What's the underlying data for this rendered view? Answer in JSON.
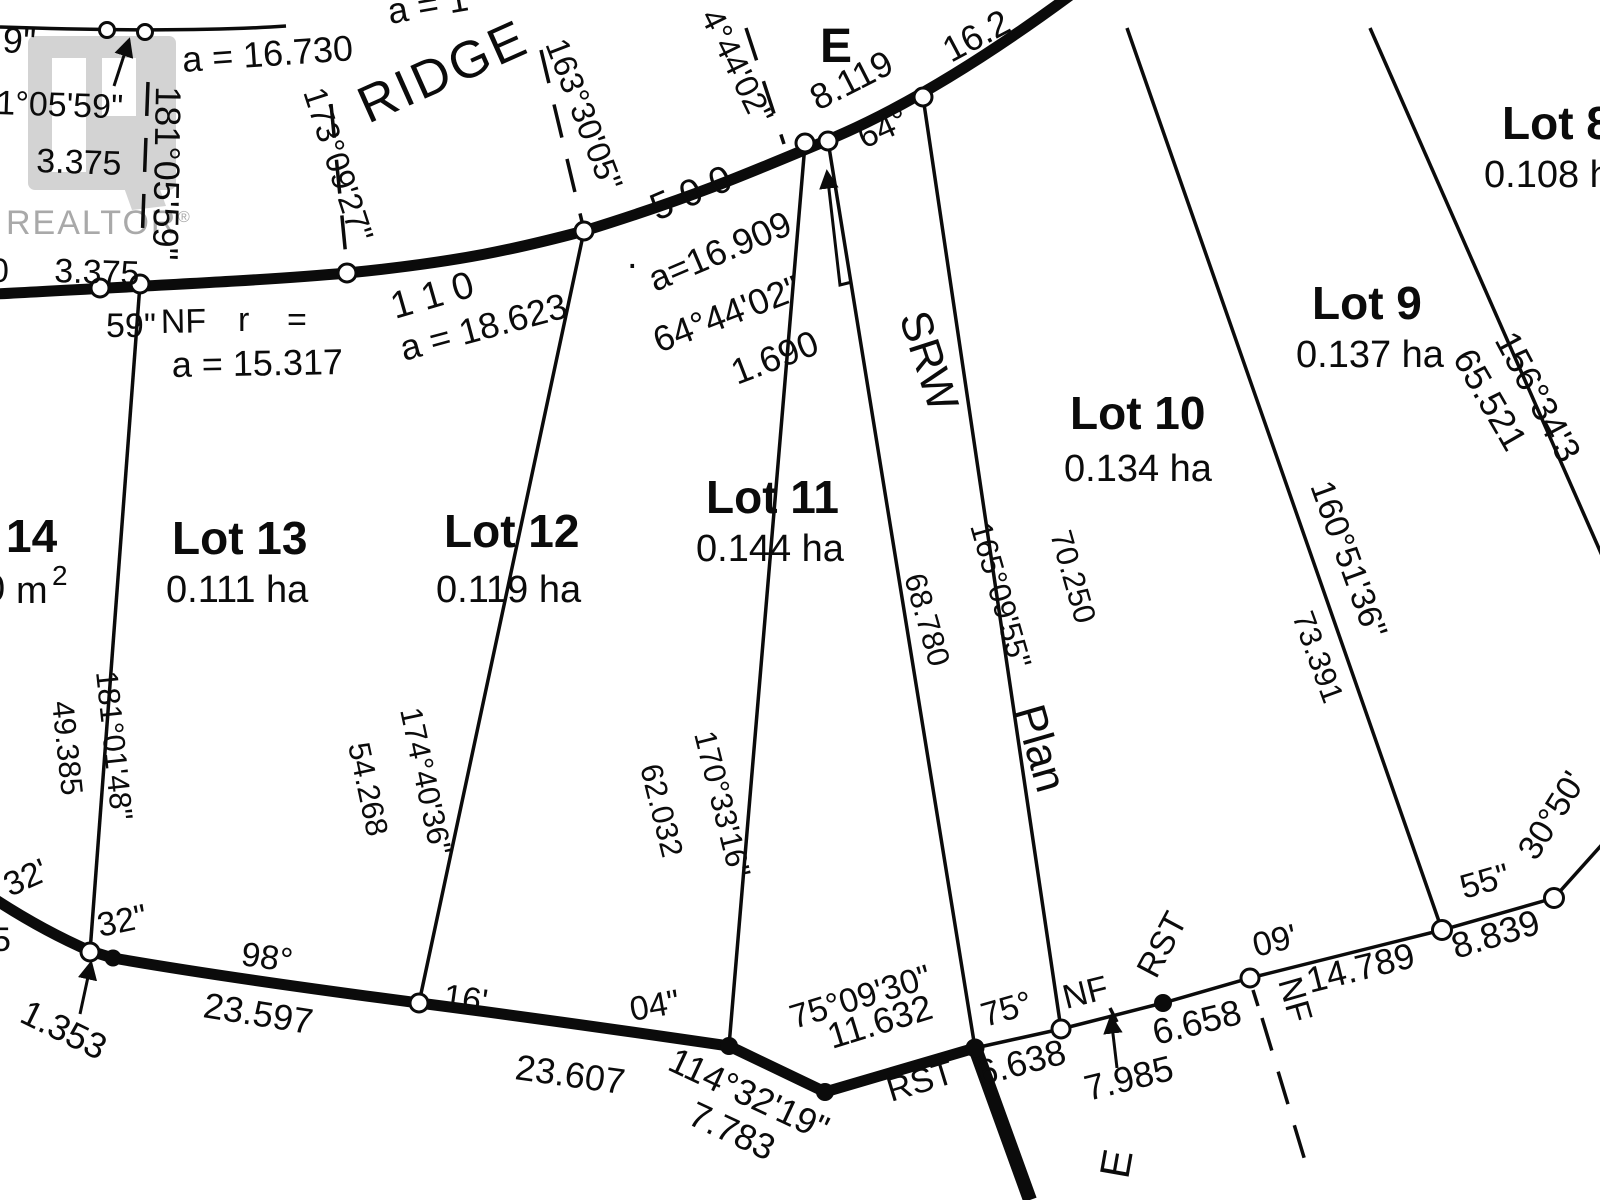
{
  "watermark": {
    "brand": "REALTOR",
    "registered": "®"
  },
  "streets": {
    "ridge": "RIDGE",
    "e_top": "E",
    "e_bottom": "E"
  },
  "srw": {
    "name": "SRW",
    "plan": "Plan"
  },
  "lots": [
    {
      "label": "Lot 8",
      "area": "0.108 ha"
    },
    {
      "label": "Lot 9",
      "area": "0.137 ha"
    },
    {
      "label": "Lot 10",
      "area": "0.134 ha"
    },
    {
      "label": "Lot 11",
      "area": "0.144 ha"
    },
    {
      "label": "Lot 12",
      "area": "0.119 ha"
    },
    {
      "label": "Lot 13",
      "area": "0.111 ha"
    },
    {
      "label": "14",
      "area_partial": "0",
      "area_unit": "m",
      "area_exponent": "2"
    }
  ],
  "annotations": {
    "partial_9in": "9\"",
    "bearing_181_05_59_a": "1°05'59\"",
    "dist_3375_a": "3.375",
    "bearing_181_05_59_b": "181°05'59\"",
    "arc_16730": "a = 16.730",
    "arc_partial_top": "a = 1",
    "bearing_173_09_27": "173°09'27\"",
    "bearing_163_30_05": "163°30'05\"",
    "bearing_4_44_02": "4°44'02\"",
    "dist_8119": "8.119",
    "dist_16_2_partial": "16.2",
    "angle_64": "64°",
    "num_500": "5 0 0",
    "dot": ".",
    "arc_16909": "a=16.909",
    "bearing_64_44_02": "64°44'02\"",
    "dist_1690": "1.690",
    "num_110": "1 1 0",
    "arc_18623": "a = 18.623",
    "partial_0": "0",
    "dist_3375_b": "3.375",
    "frag_59in": "59\"",
    "monument_nf_a": "NF",
    "frag_r": "r",
    "frag_eq": "=",
    "arc_15317": "a = 15.317",
    "dist_49385": "49.385",
    "bearing_181_01_48": "181°01'48\"",
    "dist_54268": "54.268",
    "bearing_174_40_36": "174°40'36\"",
    "dist_62032": "62.032",
    "bearing_170_33_16": "170°33'16\"",
    "dist_68780": "68.780",
    "bearing_165_09_55": "165°09'55\"",
    "dist_70250": "70.250",
    "dist_73391": "73.391",
    "bearing_160_51_36": "160°51'36\"",
    "bearing_156_34_3": "156°34'3",
    "dist_65521": "65.521",
    "bearing_30_50": "30°50'",
    "frag_55in": "55\"",
    "dist_8839": "8.839",
    "frag_09ft": "09'",
    "dist_14789": "14.789",
    "monument_nf_b": "NF",
    "dist_6658": "6.658",
    "monument_rst_a": "RST",
    "dist_7985": "7.985",
    "monument_nf_c": "NF",
    "angle_75": "75°",
    "dist_6638": "6.638",
    "monument_rst_b": "RST",
    "bearing_75_09_30": "75°09'30\"",
    "dist_11632": "11.632",
    "bearing_114_32_19": "114°32'19\"",
    "dist_7783": "7.783",
    "frag_04in": "04\"",
    "dist_23607": "23.607",
    "frag_16ft": "16'",
    "angle_98": "98°",
    "dist_23597": "23.597",
    "frag_32ft": "32'",
    "frag_32in": "32\"",
    "partial_5": "5",
    "dist_1353": "1.353"
  }
}
